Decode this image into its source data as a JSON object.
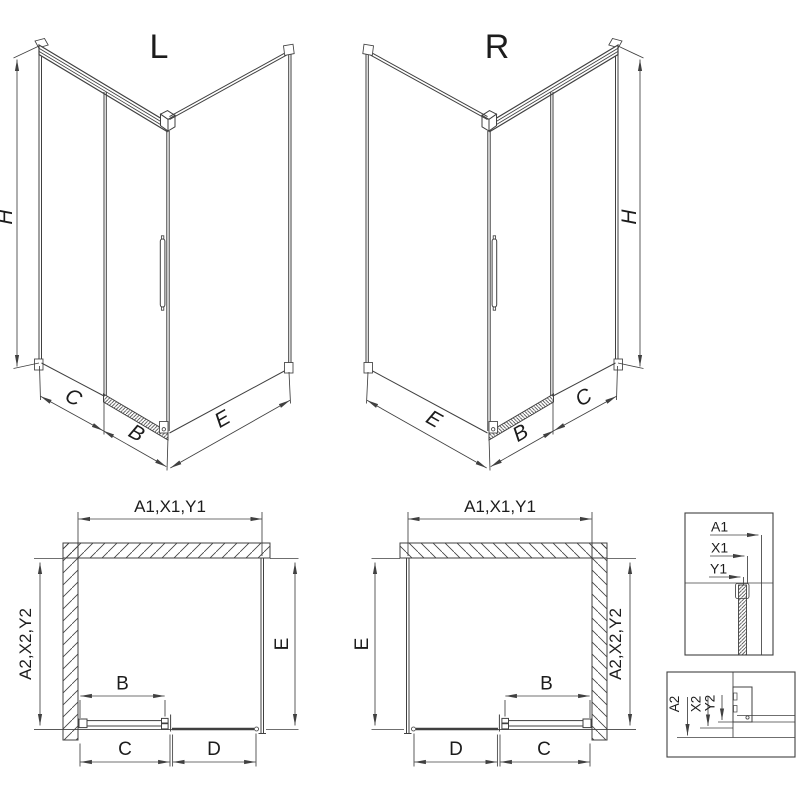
{
  "drawing": {
    "perspective_left": {
      "title": "L",
      "dim_height": "H",
      "dim_fixed_width": "C",
      "dim_door_width": "B",
      "dim_side_panel": "E"
    },
    "perspective_right": {
      "title": "R",
      "dim_height": "H",
      "dim_fixed_width": "C",
      "dim_door_width": "B",
      "dim_side_panel": "E"
    },
    "plan_left": {
      "dim_width_top": "A1,X1,Y1",
      "dim_depth": "A2,X2,Y2",
      "dim_side_panel": "E",
      "dim_door": "B",
      "dim_fixed": "C",
      "dim_opening": "D"
    },
    "plan_right": {
      "dim_width_top": "A1,X1,Y1",
      "dim_depth": "A2,X2,Y2",
      "dim_side_panel": "E",
      "dim_door": "B",
      "dim_fixed": "C",
      "dim_opening": "D"
    },
    "detail_top": {
      "dim_a": "A1",
      "dim_x": "X1",
      "dim_y": "Y1"
    },
    "detail_bottom": {
      "dim_a": "A2",
      "dim_x": "X2",
      "dim_y": "Y2"
    }
  },
  "colors": {
    "line": "#404040",
    "text": "#1c1c1c",
    "background": "#ffffff"
  }
}
